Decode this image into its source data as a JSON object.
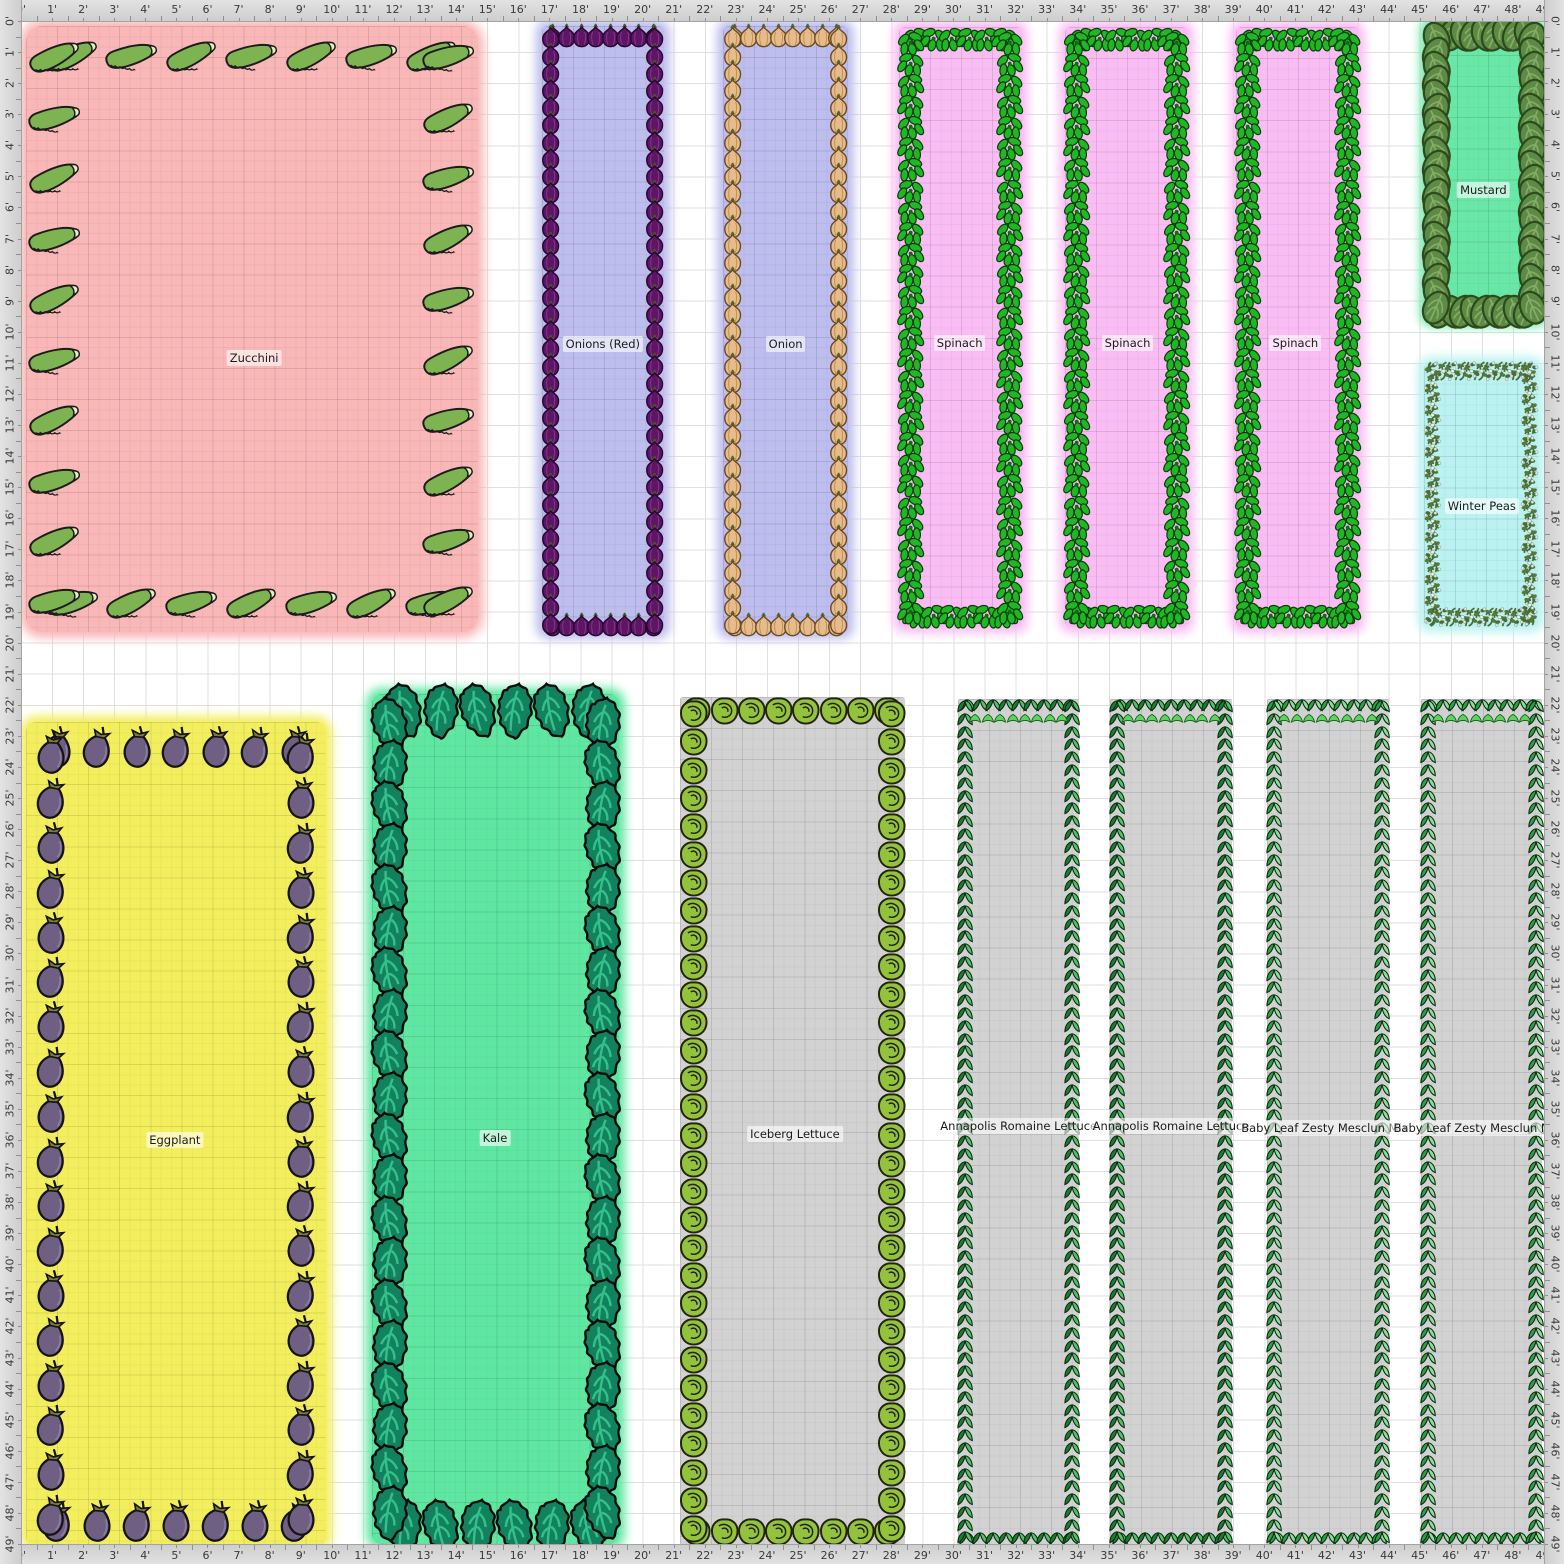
{
  "app": {
    "name": "garden-planner-canvas",
    "grid_feet": 49
  },
  "ruler": {
    "unit_suffix": "'",
    "labels": [
      "0'",
      "1'",
      "2'",
      "3'",
      "4'",
      "5'",
      "6'",
      "7'",
      "8'",
      "9'",
      "10'",
      "11'",
      "12'",
      "13'",
      "14'",
      "15'",
      "16'",
      "17'",
      "18'",
      "19'",
      "20'",
      "21'",
      "22'",
      "23'",
      "24'",
      "25'",
      "26'",
      "27'",
      "28'",
      "29'",
      "30'",
      "31'",
      "32'",
      "33'",
      "34'",
      "35'",
      "36'",
      "37'",
      "38'",
      "39'",
      "40'",
      "41'",
      "42'",
      "43'",
      "44'",
      "45'",
      "46'",
      "47'",
      "48'",
      "49'"
    ]
  },
  "colors": {
    "ruler_bg": "#d8d8d8",
    "ruler_text": "#3a3a3a",
    "grid_line": "#dfdfdf",
    "zucchini_bed": "#f9b7b7",
    "onion_bed": "#bdbdee",
    "spinach_bed": "#f9bdf3",
    "mustard_bed": "#69e7a7",
    "peas_bed": "#b9f2f0",
    "eggplant_bed": "#f3ee5e",
    "kale_bed": "#5fe7a2",
    "gray_bed": "#d2d2d2"
  },
  "beds": [
    {
      "id": "zucchini",
      "label": "Zucchini",
      "x": 0.15,
      "y": 0.15,
      "w": 14.55,
      "h": 19.5,
      "fill": "#f9b7b7",
      "glow": true,
      "radius": 16,
      "label_at": [
        7.5,
        10.85
      ],
      "icon": {
        "type": "zucchini",
        "name": "zucchini-icon",
        "size": 1.85,
        "top": 7,
        "bottom": 7,
        "left": 10,
        "right": 10,
        "inset": 0.95,
        "edge_margin": 1.5,
        "vmargin": 1.0,
        "rot": -14,
        "alt": 5
      }
    },
    {
      "id": "onions-red",
      "label": "Onions (Red)",
      "x": 16.75,
      "y": 0.15,
      "w": 3.95,
      "h": 19.55,
      "fill": "#bdbdee",
      "glow": true,
      "radius": 6,
      "label_at": [
        18.72,
        10.4
      ],
      "icon": {
        "type": "onion-red",
        "name": "red-onion-icon",
        "size": 0.62,
        "top": 8,
        "bottom": 8,
        "left": 35,
        "right": 35,
        "inset": 0.3,
        "edge_margin": 0.35,
        "vmargin": 0.35,
        "rot": 0,
        "alt": 0
      }
    },
    {
      "id": "onion",
      "label": "Onion",
      "x": 22.6,
      "y": 0.15,
      "w": 4.0,
      "h": 19.55,
      "fill": "#bdbdee",
      "glow": true,
      "radius": 6,
      "label_at": [
        24.6,
        10.4
      ],
      "icon": {
        "type": "onion-tan",
        "name": "onion-icon",
        "size": 0.62,
        "top": 8,
        "bottom": 8,
        "left": 35,
        "right": 35,
        "inset": 0.3,
        "edge_margin": 0.35,
        "vmargin": 0.35,
        "rot": 0,
        "alt": 0
      }
    },
    {
      "id": "spinach-1",
      "label": "Spinach",
      "x": 28.25,
      "y": 0.2,
      "w": 3.95,
      "h": 19.3,
      "fill": "#f9bdf3",
      "glow": true,
      "radius": 6,
      "label_at": [
        30.2,
        10.35
      ],
      "icon": {
        "type": "spinach",
        "name": "spinach-icon",
        "size": 0.88,
        "top": 6,
        "bottom": 6,
        "left": 28,
        "right": 28,
        "inset": 0.38,
        "edge_margin": 0.55,
        "vmargin": 0.5,
        "rot": 0,
        "alt": 14
      }
    },
    {
      "id": "spinach-2",
      "label": "Spinach",
      "x": 33.6,
      "y": 0.2,
      "w": 3.95,
      "h": 19.3,
      "fill": "#f9bdf3",
      "glow": true,
      "radius": 6,
      "label_at": [
        35.6,
        10.35
      ],
      "icon": {
        "type": "spinach",
        "name": "spinach-icon",
        "size": 0.88,
        "top": 6,
        "bottom": 6,
        "left": 28,
        "right": 28,
        "inset": 0.38,
        "edge_margin": 0.55,
        "vmargin": 0.5,
        "rot": 0,
        "alt": 14
      }
    },
    {
      "id": "spinach-3",
      "label": "Spinach",
      "x": 39.1,
      "y": 0.2,
      "w": 3.95,
      "h": 19.3,
      "fill": "#f9bdf3",
      "glow": true,
      "radius": 6,
      "label_at": [
        41.0,
        10.35
      ],
      "icon": {
        "type": "spinach",
        "name": "spinach-icon",
        "size": 0.88,
        "top": 6,
        "bottom": 6,
        "left": 28,
        "right": 28,
        "inset": 0.38,
        "edge_margin": 0.55,
        "vmargin": 0.5,
        "rot": 0,
        "alt": 14
      }
    },
    {
      "id": "mustard",
      "label": "Mustard",
      "x": 45.2,
      "y": 0.1,
      "w": 3.75,
      "h": 9.55,
      "fill": "#69e7a7",
      "glow": true,
      "radius": 6,
      "label_at": [
        47.05,
        5.45
      ],
      "icon": {
        "type": "mustard",
        "name": "mustard-leaf-icon",
        "size": 0.92,
        "top": 9,
        "bottom": 9,
        "left": 20,
        "right": 20,
        "inset": 0.32,
        "edge_margin": 0.5,
        "vmargin": 0.45,
        "rot": 0,
        "alt": 24
      }
    },
    {
      "id": "winter-peas",
      "label": "Winter Peas",
      "x": 45.15,
      "y": 11.0,
      "w": 3.65,
      "h": 8.45,
      "fill": "#b9f2f0",
      "glow": true,
      "radius": 6,
      "label_at": [
        47.0,
        15.6
      ],
      "icon": {
        "type": "peas",
        "name": "pea-vine-icon",
        "size": 0.55,
        "top": 11,
        "bottom": 11,
        "left": 24,
        "right": 24,
        "inset": 0.27,
        "edge_margin": 0.3,
        "vmargin": 0.3,
        "rot": 0,
        "alt": 18
      }
    },
    {
      "id": "eggplant",
      "label": "Eggplant",
      "x": 0.15,
      "y": 22.55,
      "w": 9.65,
      "h": 26.5,
      "fill": "#f3ee5e",
      "glow": true,
      "radius": 10,
      "label_at": [
        4.95,
        36.0
      ],
      "icon": {
        "type": "eggplant",
        "name": "eggplant-icon",
        "size": 1.12,
        "top": 7,
        "bottom": 7,
        "left": 18,
        "right": 18,
        "inset": 0.8,
        "edge_margin": 1.0,
        "vmargin": 1.0,
        "rot": 8,
        "alt": 4
      }
    },
    {
      "id": "kale",
      "label": "Kale",
      "x": 11.3,
      "y": 21.65,
      "w": 7.95,
      "h": 27.35,
      "fill": "#5fe7a2",
      "glow": true,
      "radius": 10,
      "label_at": [
        15.25,
        35.95
      ],
      "icon": {
        "type": "kale",
        "name": "kale-leaf-icon",
        "size": 1.3,
        "top": 6,
        "bottom": 6,
        "left": 20,
        "right": 20,
        "inset": 0.55,
        "edge_margin": 1.0,
        "vmargin": 1.0,
        "rot": 0,
        "alt": 10
      }
    },
    {
      "id": "iceberg-lettuce",
      "label": "Iceberg Lettuce",
      "x": 21.2,
      "y": 21.75,
      "w": 7.25,
      "h": 27.3,
      "fill": "#d2d2d2",
      "glow": false,
      "radius": 3,
      "label_at": [
        24.9,
        35.8
      ],
      "icon": {
        "type": "lettuce",
        "name": "lettuce-head-icon",
        "size": 0.95,
        "top": 8,
        "bottom": 8,
        "left": 30,
        "right": 30,
        "inset": 0.45,
        "edge_margin": 0.55,
        "vmargin": 0.55,
        "rot": 0,
        "alt": 0
      }
    },
    {
      "id": "romaine-1",
      "label": "Annapolis Romaine Lettuce",
      "x": 30.15,
      "y": 21.8,
      "w": 3.9,
      "h": 27.25,
      "fill": "#d2d2d2",
      "glow": false,
      "radius": 2,
      "label_at": [
        32.1,
        35.55
      ],
      "icon": {
        "type": "braid",
        "name": "romaine-lettuce-icon",
        "size": 0.52,
        "top": 9,
        "bottom": 9,
        "left": 66,
        "right": 66,
        "inset": 0.22,
        "edge_margin": 0.3,
        "vmargin": 0.25,
        "rot": 0,
        "alt": 0,
        "extra_tufts": 8
      }
    },
    {
      "id": "romaine-2",
      "label": "Annapolis Romaine Lettuce",
      "x": 35.05,
      "y": 21.8,
      "w": 3.9,
      "h": 27.25,
      "fill": "#d2d2d2",
      "glow": false,
      "radius": 2,
      "label_at": [
        37.0,
        35.55
      ],
      "icon": {
        "type": "braid",
        "name": "romaine-lettuce-icon",
        "size": 0.52,
        "top": 9,
        "bottom": 9,
        "left": 66,
        "right": 66,
        "inset": 0.22,
        "edge_margin": 0.3,
        "vmargin": 0.25,
        "rot": 0,
        "alt": 0,
        "extra_tufts": 8
      }
    },
    {
      "id": "mesclun-1",
      "label": "Baby Leaf Zesty Mesclun Mix",
      "x": 40.1,
      "y": 21.8,
      "w": 3.9,
      "h": 27.25,
      "fill": "#d2d2d2",
      "glow": false,
      "radius": 2,
      "label_at": [
        41.95,
        35.6
      ],
      "icon": {
        "type": "braid2",
        "name": "mesclun-mix-icon",
        "size": 0.52,
        "top": 9,
        "bottom": 9,
        "left": 66,
        "right": 66,
        "inset": 0.22,
        "edge_margin": 0.3,
        "vmargin": 0.25,
        "rot": 0,
        "alt": 0,
        "extra_tufts": 8
      }
    },
    {
      "id": "mesclun-2",
      "label": "Baby Leaf Zesty Mesclun Mix",
      "x": 45.05,
      "y": 21.8,
      "w": 3.9,
      "h": 27.25,
      "fill": "#d2d2d2",
      "glow": false,
      "radius": 2,
      "label_at": [
        46.85,
        35.6
      ],
      "icon": {
        "type": "braid2",
        "name": "mesclun-mix-icon",
        "size": 0.52,
        "top": 9,
        "bottom": 9,
        "left": 66,
        "right": 66,
        "inset": 0.22,
        "edge_margin": 0.3,
        "vmargin": 0.25,
        "rot": 0,
        "alt": 0,
        "extra_tufts": 8
      }
    }
  ]
}
